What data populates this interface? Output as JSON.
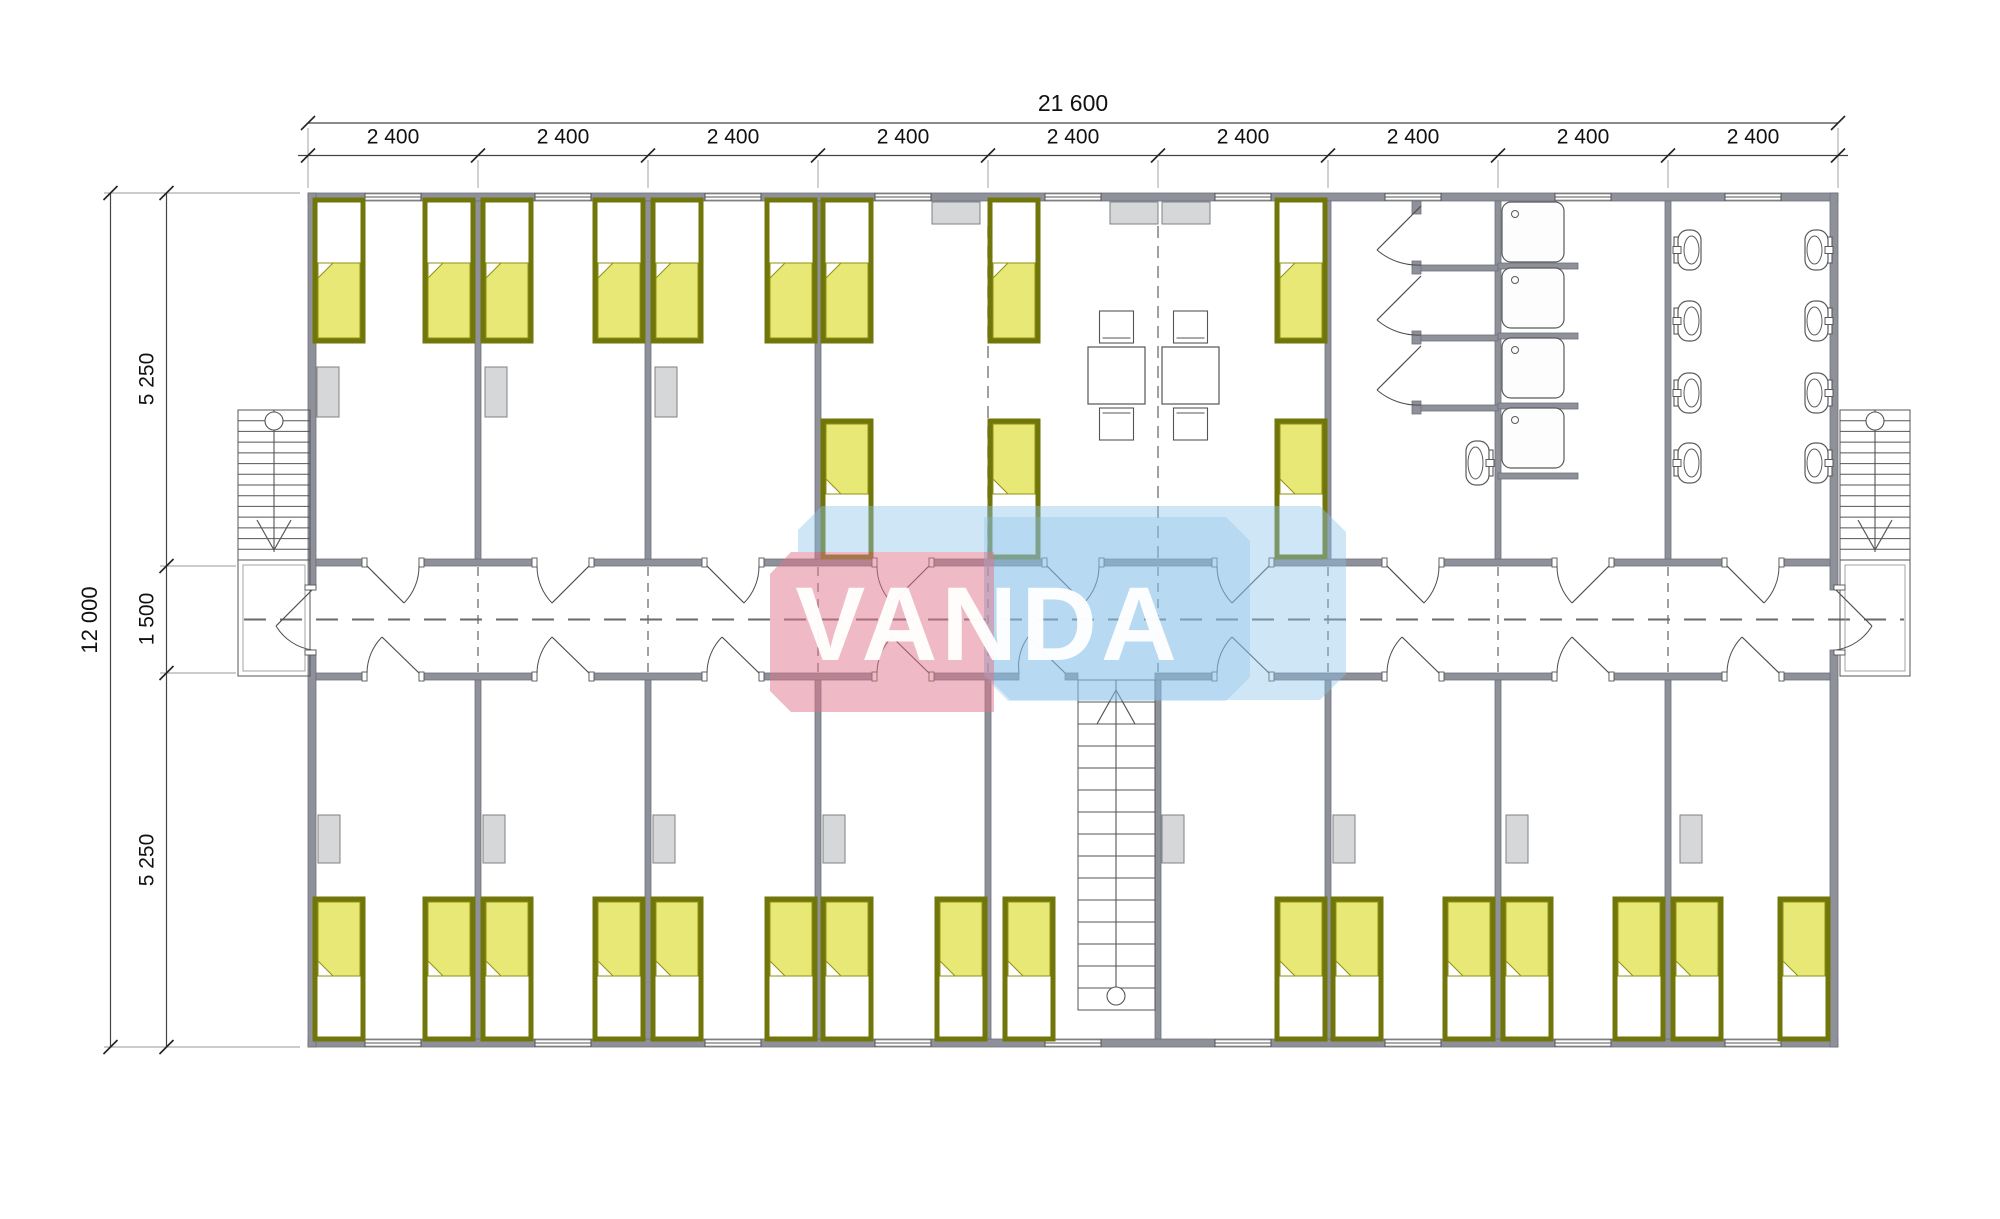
{
  "watermark": {
    "text": "VANDA",
    "pink_fill": "rgba(223,118,139,0.50)",
    "blue_fill": "rgba(140,196,233,0.42)",
    "blue_main_fill": "rgba(130,188,228,0.30)",
    "text_fill": "rgba(255,255,255,0.95)",
    "pink_poly": [
      [
        770,
        574
      ],
      [
        791,
        552
      ],
      [
        994,
        552
      ],
      [
        994,
        712
      ],
      [
        791,
        712
      ],
      [
        770,
        691
      ]
    ],
    "blue_poly": [
      [
        822,
        506
      ],
      [
        1320,
        506
      ],
      [
        1346,
        532
      ],
      [
        1346,
        674
      ],
      [
        1320,
        700
      ],
      [
        1010,
        700
      ],
      [
        984,
        674
      ],
      [
        984,
        552
      ],
      [
        798,
        552
      ],
      [
        798,
        530
      ]
    ],
    "blue_main_poly": [
      [
        984,
        517
      ],
      [
        1226,
        517
      ],
      [
        1250,
        541
      ],
      [
        1250,
        677
      ],
      [
        1226,
        701
      ],
      [
        1008,
        701
      ],
      [
        984,
        677
      ]
    ],
    "text_x": 988,
    "text_y": 660,
    "font_size": 105,
    "letter_spacing": 4
  },
  "dimensions": {
    "top_total_label": "21 600",
    "module_labels": [
      "2 400",
      "2 400",
      "2 400",
      "2 400",
      "2 400",
      "2 400",
      "2 400",
      "2 400",
      "2 400"
    ],
    "left_total_label": "12 000",
    "left_segment_labels": [
      "5 250",
      "1 500",
      "5 250"
    ],
    "left_segment_pos": [
      379,
      619,
      860
    ],
    "top_line1_y": 123,
    "top_line2_y": 155.5,
    "left_line1_x": 110.5,
    "left_line2_x": 166.5,
    "left_ticks": [
      193,
      566,
      673,
      1047
    ],
    "total_label_xy": [
      1073,
      111
    ],
    "left_total_label_xy": [
      97,
      620
    ]
  },
  "colors": {
    "wall": "#8e909a",
    "wall_stroke": "#6e707a",
    "line": "#555555",
    "thin": "#777777",
    "dim": "#333333",
    "text": "#111111",
    "bed_frame": "#71760a",
    "bed_blanket": "#e7e876",
    "bed_blanket_stroke": "#8f9212",
    "wardrobe": "#d6d7d8",
    "wardrobe_stroke": "#7e8084",
    "fixture": "#ffffff",
    "fixture_stroke": "#5a5a5a"
  },
  "plan": {
    "module_bounds": [
      308,
      478,
      648,
      818,
      988,
      1158,
      1328,
      1498,
      1668,
      1838
    ],
    "module_centers": [
      393,
      563,
      733,
      903,
      1073,
      1243,
      1413,
      1583,
      1753
    ],
    "outer": {
      "x": 308,
      "y": 193,
      "w": 1530,
      "h": 854,
      "th": 8
    },
    "corridor": {
      "top_wall_y": 559,
      "bottom_wall_y": 673,
      "wall_th": 7,
      "center_y": 619.5,
      "centerline_x1": 244,
      "centerline_x2": 1904
    },
    "side_wall_gap": [
      590,
      650
    ],
    "upper_partitions": [
      478,
      648,
      818,
      1328,
      1498,
      1668
    ],
    "lower_partitions": [
      478,
      648,
      818,
      988,
      1158,
      1328,
      1498,
      1668
    ],
    "upper_dashed_x": [
      988,
      1158
    ],
    "upper_dashed_y": [
      226,
      558
    ],
    "corridor_cross_dashed_x": [
      478,
      648,
      818,
      988,
      1158,
      1328,
      1498,
      1668
    ],
    "corridor_top_segments": [
      [
        316,
        367
      ],
      [
        419,
        537
      ],
      [
        589,
        707
      ],
      [
        759,
        877
      ],
      [
        929,
        1047
      ],
      [
        1099,
        1217
      ],
      [
        1269,
        1387
      ],
      [
        1439,
        1557
      ],
      [
        1609,
        1727
      ],
      [
        1779,
        1830
      ]
    ],
    "corridor_bottom_segments": [
      [
        316,
        367
      ],
      [
        419,
        537
      ],
      [
        589,
        707
      ],
      [
        759,
        877
      ],
      [
        929,
        1019
      ],
      [
        1065,
        1078
      ],
      [
        1155,
        1217
      ],
      [
        1269,
        1387
      ],
      [
        1439,
        1557
      ],
      [
        1609,
        1727
      ],
      [
        1779,
        1830
      ]
    ],
    "doors_top": [
      {
        "c": 393,
        "hinge": "left"
      },
      {
        "c": 563,
        "hinge": "right"
      },
      {
        "c": 733,
        "hinge": "left"
      },
      {
        "c": 903,
        "hinge": "right"
      },
      {
        "c": 1073,
        "hinge": "left"
      },
      {
        "c": 1243,
        "hinge": "right"
      },
      {
        "c": 1413,
        "hinge": "left"
      },
      {
        "c": 1583,
        "hinge": "right"
      },
      {
        "c": 1753,
        "hinge": "left"
      }
    ],
    "doors_bottom": [
      {
        "c": 393
      },
      {
        "c": 563
      },
      {
        "c": 733
      },
      {
        "c": 903
      },
      {
        "c": 1243
      },
      {
        "c": 1413
      },
      {
        "c": 1583
      },
      {
        "c": 1753
      }
    ],
    "door_half": 26,
    "stair_door": {
      "h": [
        1065,
        673
      ],
      "e": [
        1028,
        637
      ],
      "a": [
        1019,
        673
      ],
      "sweep": 1
    },
    "end_doors": [
      {
        "h": [
          312,
          590
        ],
        "e": [
          276,
          626
        ],
        "a": [
          312,
          650
        ],
        "sweep": 1
      },
      {
        "h": [
          1836,
          590
        ],
        "e": [
          1872,
          626
        ],
        "a": [
          1836,
          650
        ],
        "sweep": 0
      }
    ],
    "stall_doors_y": [
      206,
      276,
      346
    ],
    "stall_stubs": {
      "x": 1420,
      "len": 78,
      "ys": [
        265,
        335,
        405
      ],
      "post_x": 1412,
      "post_ys": [
        201,
        261,
        331,
        401
      ]
    },
    "shower_separators": {
      "x": 1498,
      "len": 80,
      "ys": [
        263,
        333,
        403,
        473
      ]
    },
    "windows": {
      "centers": [
        393,
        563,
        733,
        903,
        1073,
        1243,
        1413,
        1583,
        1753
      ],
      "w": 56,
      "top_y": 193,
      "bottom_y": 1039,
      "th": 8
    },
    "beds": {
      "w": 48,
      "rows": [
        {
          "y": 200,
          "h": 141,
          "pillow": "top",
          "xs": [
            315,
            425,
            483,
            595,
            653,
            767,
            823,
            990,
            1277
          ]
        },
        {
          "y": 421,
          "h": 136,
          "pillow": "bottom",
          "xs": [
            823,
            990,
            1277
          ]
        },
        {
          "y": 899,
          "h": 140,
          "pillow": "bottom",
          "xs": [
            315,
            425,
            483,
            595,
            653,
            767,
            823,
            937,
            1005,
            1277,
            1333,
            1445,
            1503,
            1615,
            1673,
            1780
          ]
        }
      ]
    },
    "wardrobes": [
      {
        "y": 367,
        "w": 22,
        "h": 50,
        "xs": [
          317,
          485,
          655
        ]
      },
      {
        "y": 202,
        "w": 48,
        "h": 22,
        "xs": [
          932,
          1110,
          1162
        ]
      },
      {
        "y": 815,
        "w": 22,
        "h": 48,
        "xs": [
          318,
          483,
          653,
          823,
          1162,
          1333,
          1506,
          1680
        ]
      }
    ],
    "tables": {
      "size": 57,
      "y": 347,
      "xs": [
        1088,
        1162
      ],
      "chair_w": 34,
      "chair_h": 32
    },
    "showers": {
      "x": 1502,
      "w": 62,
      "h": 60,
      "ys": [
        202,
        268,
        338,
        408
      ],
      "drain_dx": 13,
      "drain_dy": 12,
      "drain_r": 3.5
    },
    "toilets": [
      {
        "x": 1674,
        "facing": "right",
        "w": 27,
        "h": 40,
        "ys": [
          230,
          301,
          373,
          443
        ]
      },
      {
        "x": 1805,
        "facing": "left",
        "w": 27,
        "h": 40,
        "ys": [
          230,
          301,
          373,
          443
        ]
      },
      {
        "x": 1466,
        "facing": "left",
        "w": 27,
        "h": 44,
        "ys": [
          441
        ]
      }
    ],
    "stairs": [
      {
        "x": 238,
        "y": 410,
        "w": 72,
        "h": 150,
        "steps": 13,
        "cx": 274,
        "circle": "top",
        "arrow": "down"
      },
      {
        "x": 1840,
        "y": 410,
        "w": 70,
        "h": 150,
        "steps": 13,
        "cx": 1875,
        "circle": "top",
        "arrow": "down"
      },
      {
        "x": 1078,
        "y": 680,
        "w": 77,
        "h": 330,
        "steps": 14,
        "cx": 1116,
        "circle": "bottom",
        "arrow": "up"
      }
    ],
    "landings": [
      {
        "x": 238,
        "y": 560,
        "w": 72,
        "h": 116
      },
      {
        "x": 1840,
        "y": 560,
        "w": 70,
        "h": 116
      }
    ]
  }
}
